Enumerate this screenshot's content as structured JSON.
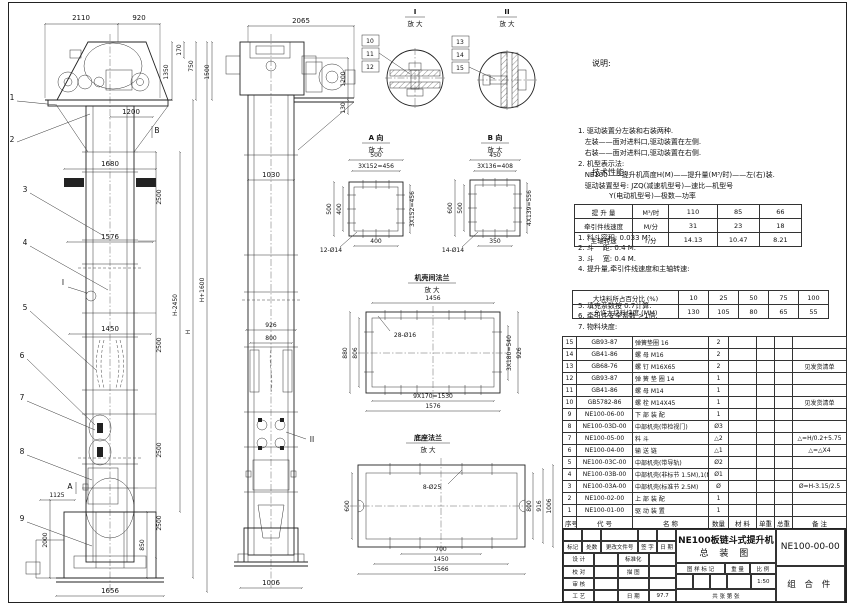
{
  "notes": {
    "title": "说明:",
    "lines": [
      "1. 驱动装置分左装和右装两种.",
      "   左装——面对进料口,驱动装置在左侧.",
      "   右装——面对进料口,驱动装置在右侧.",
      "2. 机型表示法:",
      "   NE100——提升机高度H(M)——提升量(M³/时)——左(右)装.",
      "   驱动装置型号: JZQ(减速机型号)—速比—机型号",
      "              Y(电动机型号)—极数—功率"
    ]
  },
  "tech": {
    "title": "技术性能:",
    "lines_before": [
      "1. 料斗容积: 0.033 M³.",
      "2. 斗    距: 0.4 M.",
      "3. 斗    宽: 0.4 M.",
      "4. 提升量,牵引件线速度和主轴转速:"
    ],
    "lines_after": [
      "5. 填充系数按 0.7计算.",
      "6. 牵引件安全系数 >1倍.",
      "7. 物料块度:"
    ]
  },
  "perf": {
    "rows": [
      [
        "提 升 量",
        "M³/时",
        "110",
        "85",
        "66"
      ],
      [
        "牵引件线速度",
        "M/分",
        "31",
        "23",
        "18"
      ],
      [
        "主轴转速",
        "r/分",
        "14.13",
        "10.47",
        "8.21"
      ]
    ]
  },
  "lump": {
    "rows": [
      [
        "大块料所占百分比 (%)",
        "10",
        "25",
        "50",
        "75",
        "100"
      ],
      [
        "允许大块料块度 (MM)",
        "130",
        "105",
        "80",
        "65",
        "55"
      ]
    ]
  },
  "bom": {
    "headers": [
      "序号",
      "代  号",
      "名        称",
      "数量",
      "材  料",
      "单重",
      "总重",
      "备  注"
    ],
    "rows": [
      [
        "15",
        "GB93-87",
        "弹簧垫圈  16",
        "2",
        "",
        "",
        "",
        ""
      ],
      [
        "14",
        "GB41-86",
        "螺  母  M16",
        "2",
        "",
        "",
        "",
        ""
      ],
      [
        "13",
        "GB68-76",
        "螺  钉  M16X65",
        "2",
        "",
        "",
        "",
        "见发货清单"
      ],
      [
        "12",
        "GB93-87",
        "弹 簧 垫 圈  14",
        "1",
        "",
        "",
        "",
        ""
      ],
      [
        "11",
        "GB41-86",
        "螺  母  M14",
        "1",
        "",
        "",
        "",
        ""
      ],
      [
        "10",
        "GB5782-86",
        "螺  栓  M14X45",
        "1",
        "",
        "",
        "",
        "见发货清单"
      ],
      [
        "9",
        "NE100-06-00",
        "下 部 装 配",
        "1",
        "",
        "",
        "",
        ""
      ],
      [
        "8",
        "NE100-03D-00",
        "中部机壳(带检视门)",
        "Ø3",
        "",
        "",
        "",
        ""
      ],
      [
        "7",
        "NE100-05-00",
        "料  斗",
        "△2",
        "",
        "",
        "",
        "△=H/0.2+5.75"
      ],
      [
        "6",
        "NE100-04-00",
        "输 送 链",
        "△1",
        "",
        "",
        "",
        "△=△X4"
      ],
      [
        "5",
        "NE100-03C-00",
        "中部机壳(带导轨)",
        "Ø2",
        "",
        "",
        "",
        ""
      ],
      [
        "4",
        "NE100-03B-00",
        "中部机壳(非标节 1.5M),1(M)",
        "Ø1",
        "",
        "",
        "",
        ""
      ],
      [
        "3",
        "NE100-03A-00",
        "中部机壳(标准节 2.5M)",
        "Ø",
        "",
        "",
        "",
        "Ø=H-3.15/2.5"
      ],
      [
        "2",
        "NE100-02-00",
        "上 部 装 配",
        "1",
        "",
        "",
        "",
        ""
      ],
      [
        "1",
        "NE100-01-00",
        "驱 动 装 置",
        "1",
        "",
        "",
        "",
        ""
      ]
    ]
  },
  "tb": {
    "product": "NE100板链斗式提升机",
    "sheet_name": "总  装  图",
    "dwg_no": "NE100-00-00",
    "part_class": "组 合 件",
    "rev": [
      "标记",
      "处数",
      "更改文件号",
      "签 字",
      "日 期"
    ],
    "r1a": "设 计",
    "r1b": "标准化",
    "r2a": "校 对",
    "r2b": "描 图",
    "r3a": "审 核",
    "r3b": "",
    "r4a": "工 艺",
    "r4b": "日 期",
    "date": "97.7",
    "mark": "图 样 标 记",
    "weight": "重 量",
    "scale_l": "比 例",
    "scale": "1:50",
    "sheets": "共   张   第   张"
  },
  "fv": {
    "t2110": "2110",
    "t920": "920",
    "t170": "170",
    "t750": "750",
    "t1350": "1350",
    "t1500": "1500",
    "t1200": "1200",
    "t1680": "1680",
    "t1576": "1576",
    "t1450": "1450",
    "t2500a": "2500",
    "t2500b": "2500",
    "t2500c": "2500",
    "t2500d": "2500",
    "tHp": "H+1600",
    "tHm": "H-2450",
    "tH": "H",
    "t1125": "1125",
    "t2000": "2000",
    "t850": "850",
    "t1656": "1656",
    "cA": "A",
    "cB": "B",
    "cI": "I",
    "c1": "1",
    "c2": "2",
    "c3": "3",
    "c4": "4",
    "c5": "5",
    "c6": "6",
    "c7": "7",
    "c8": "8",
    "c9": "9"
  },
  "sv": {
    "t2065": "2065",
    "t1200": "1200",
    "t130": "130",
    "t1030": "1030",
    "t926": "926",
    "t800": "800",
    "t1006": "1006",
    "cII": "II"
  },
  "di": {
    "t": "I",
    "sub": "放 大",
    "c1": "10",
    "c2": "11",
    "c3": "12"
  },
  "dii": {
    "t": "II",
    "sub": "放 大",
    "c1": "13",
    "c2": "14",
    "c3": "15"
  },
  "sa": {
    "t": "A 向",
    "sub": "放 大",
    "top": "500",
    "top2": "3X152=456",
    "l1": "500",
    "l2": "400",
    "r1": "3X152=456",
    "b1": "400",
    "holes": "12-Ø14"
  },
  "sb": {
    "t": "B 向",
    "sub": "放 大",
    "top": "450",
    "top2": "3X136=408",
    "l1": "600",
    "l2": "500",
    "r1": "4X139=556",
    "b1": "350",
    "holes": "14-Ø14"
  },
  "fm": {
    "t": "机壳间法兰",
    "sub": "放 大",
    "top": "1456",
    "holes": "28-Ø16",
    "l1": "880",
    "l2": "806",
    "r1": "3X180=540",
    "r2": "926",
    "b1": "9X170=1530",
    "b2": "1576"
  },
  "fb": {
    "t": "底座法兰",
    "sub": "放 大",
    "holes": "8-Ø25",
    "l1": "600",
    "r1": "800",
    "r2": "916",
    "r3": "1006",
    "b1": "700",
    "b2": "1450",
    "b3": "1566"
  }
}
